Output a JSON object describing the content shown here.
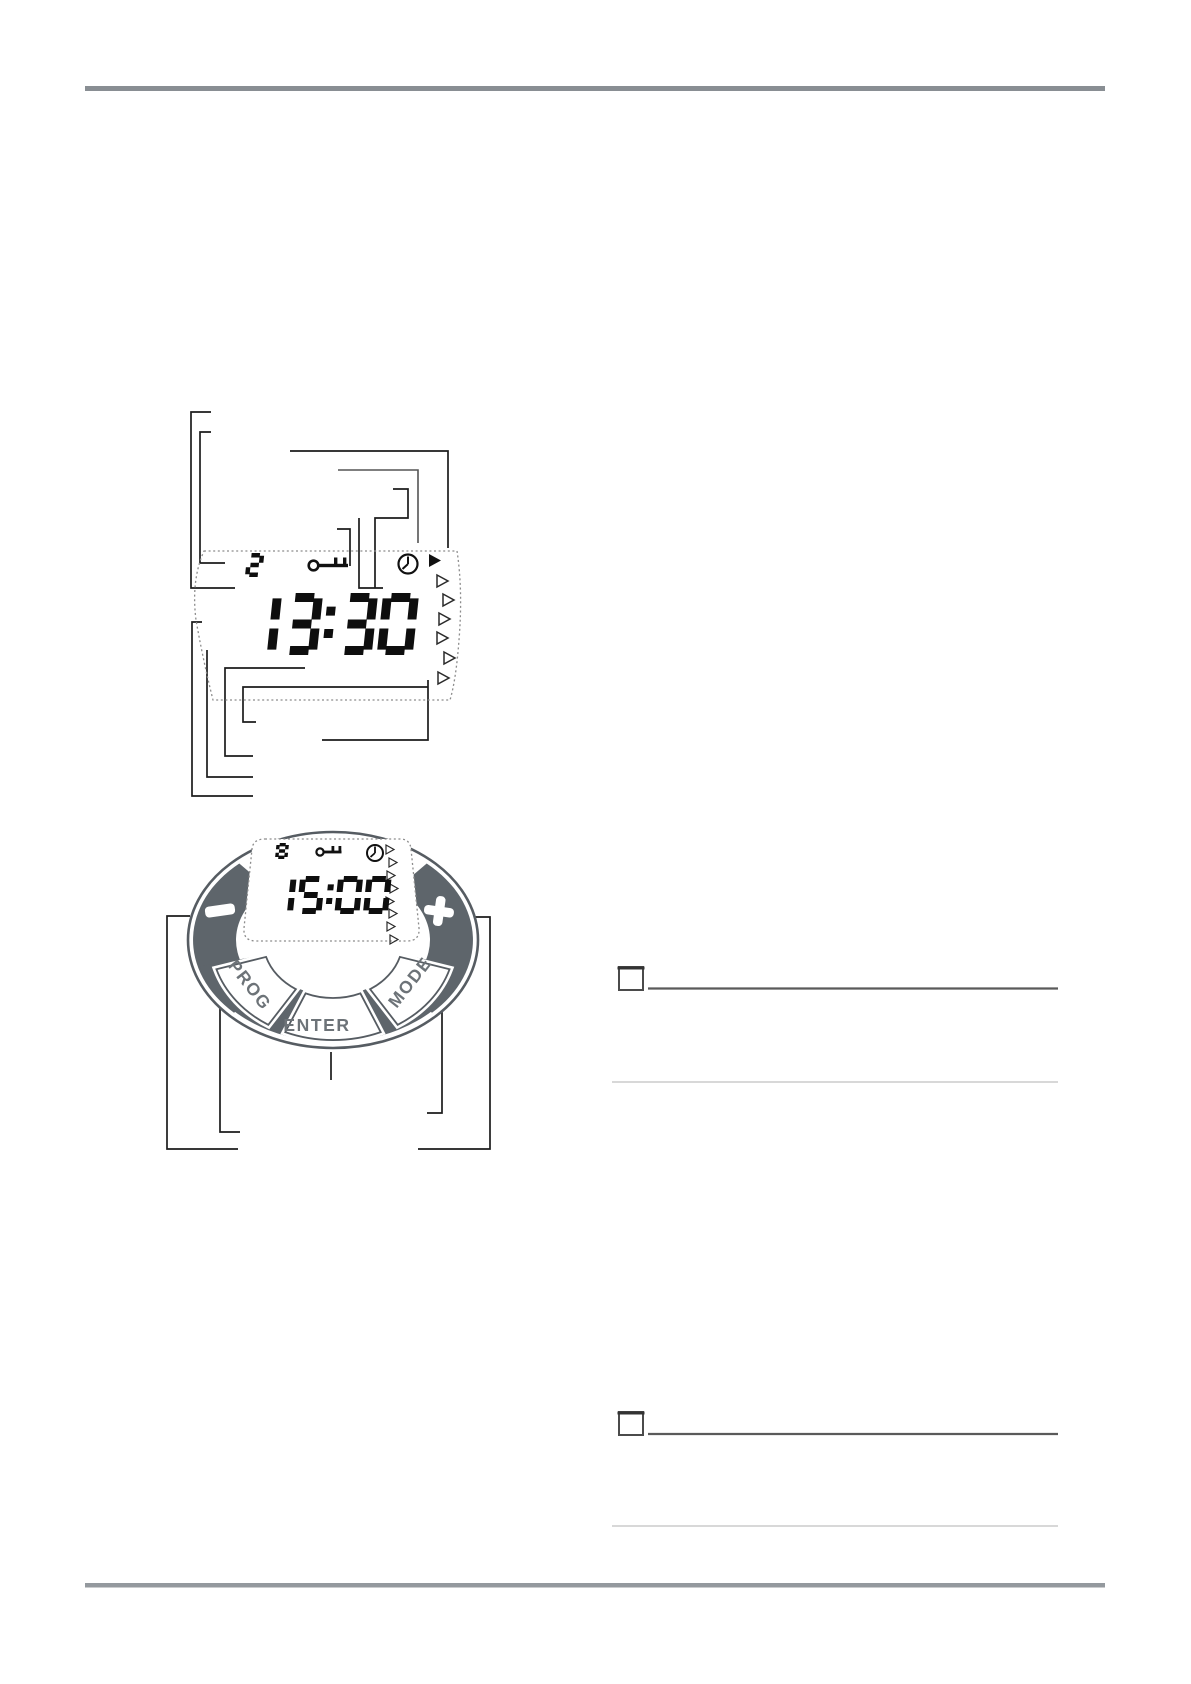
{
  "figure1": {
    "label": "lcd-display-diagram",
    "program_number": "2",
    "time": "13:30",
    "icons": {
      "key": "key-icon",
      "clock": "clock-icon",
      "active_marker": "filled-right-triangle"
    },
    "day_marker_count": 6
  },
  "figure2": {
    "label": "round-timer-device-diagram",
    "program_number": "8",
    "time": "15:00",
    "buttons": {
      "minus": "−",
      "plus": "+",
      "prog": "PROG",
      "enter": "ENTER",
      "mode": "MODE"
    },
    "day_marker_count": 8
  },
  "notes": {
    "blocks": [
      {
        "has_checkbox": true
      },
      {
        "has_checkbox": true
      }
    ]
  },
  "colors": {
    "ring_gray": "#5e656b",
    "ring_outline": "#565c62",
    "callout_black": "#1c1c1c",
    "digit_black": "#0e0e0e",
    "rule_gray": "#8a8f94",
    "note_line_dark": "#5a5a5a",
    "note_line_light": "#cbcbcb"
  }
}
